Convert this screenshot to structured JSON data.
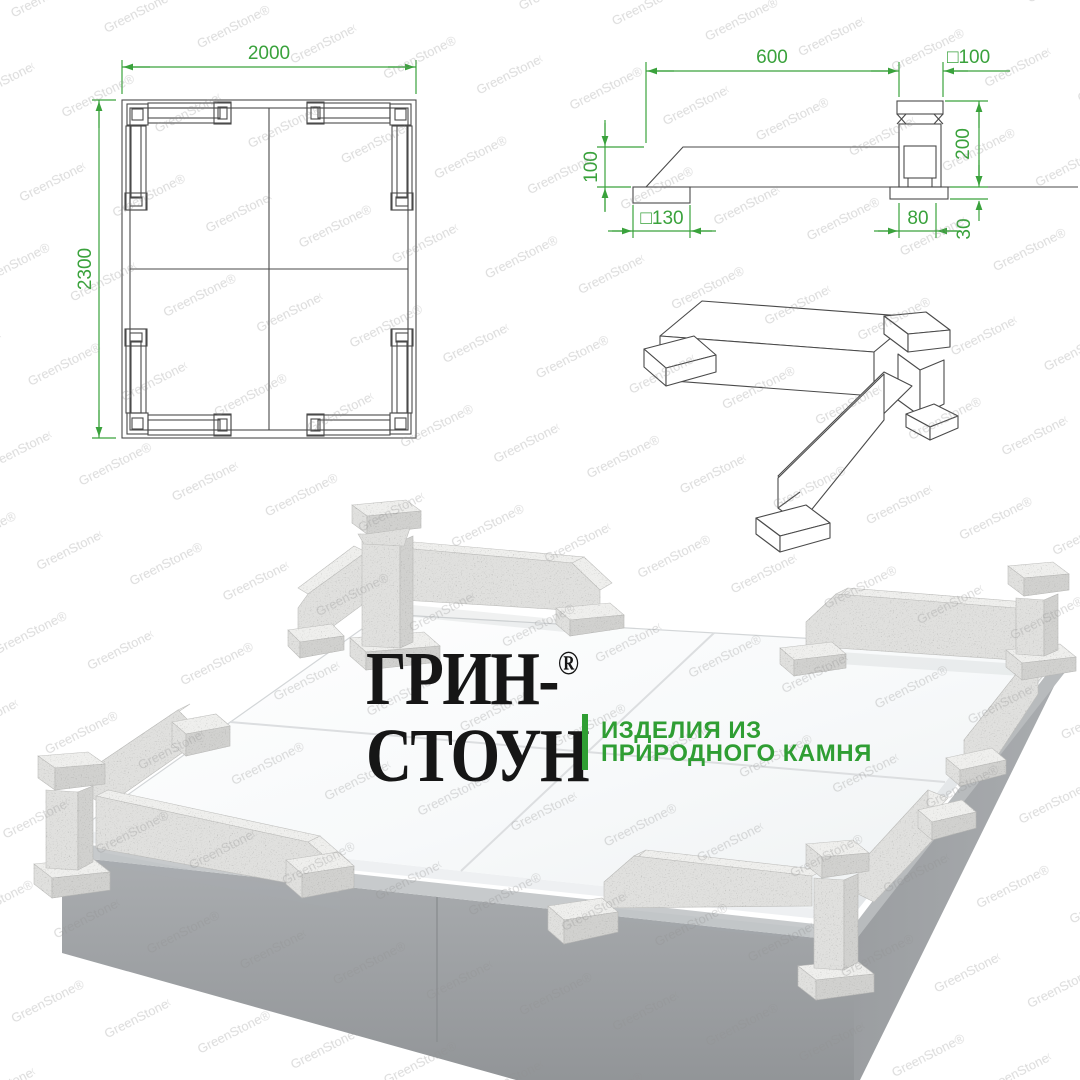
{
  "brand": {
    "name_line1": "ГРИН-",
    "registered_mark": "®",
    "name_line2": "СТОУН",
    "tagline_line1": "ИЗДЕЛИЯ ИЗ",
    "tagline_line2": "ПРИРОДНОГО КАМНЯ",
    "accent_green": "#2f9e33"
  },
  "watermark": {
    "text": "GreenStone®"
  },
  "plan_view": {
    "width_mm": "2000",
    "height_mm": "2300"
  },
  "side_view": {
    "rail_length_mm": "600",
    "post_section_mm": "□100",
    "rail_height_mm": "100",
    "post_height_mm": "200",
    "rail_pad_mm": "□130",
    "post_pad_mm": "80",
    "pad_thickness_mm": "30"
  },
  "colors": {
    "dimension_green": "#3aa23c",
    "granite_gray": "#e0e0de",
    "plinth_gray": "#a4a7aa"
  }
}
